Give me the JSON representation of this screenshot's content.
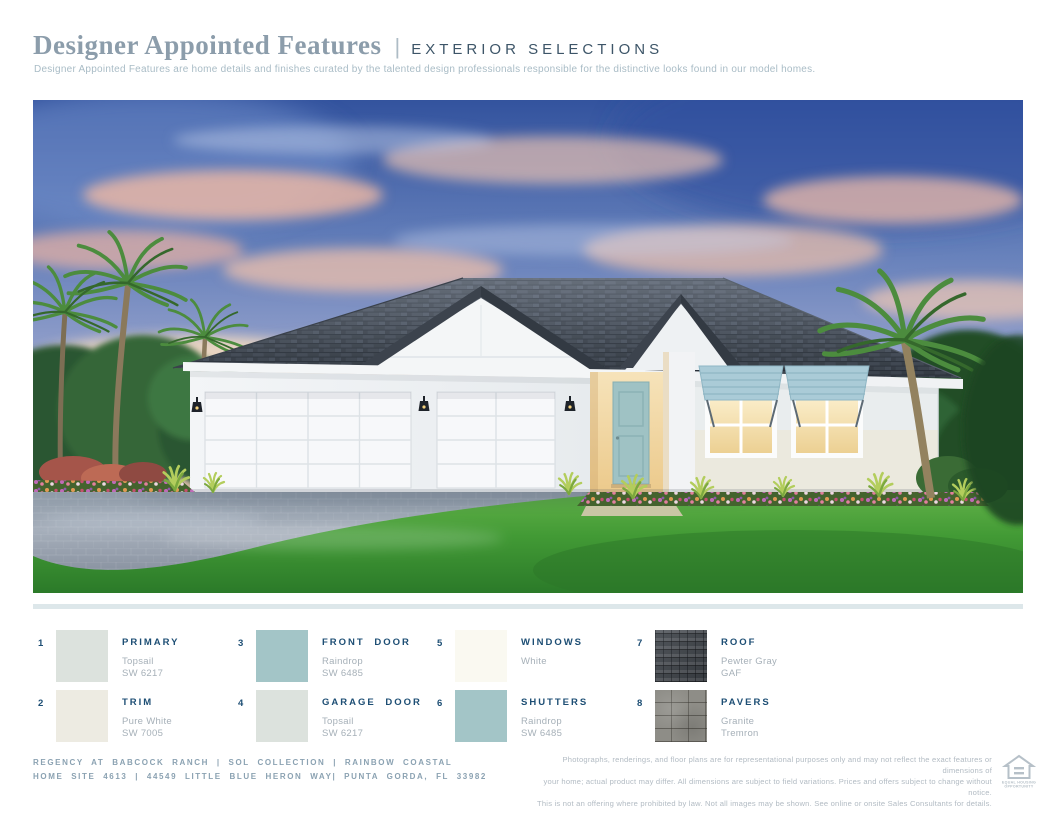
{
  "header": {
    "title": "Designer Appointed Features",
    "divider": "|",
    "section": "EXTERIOR SELECTIONS",
    "description": "Designer Appointed Features are home details and finishes curated by the talented design professionals responsible for the distinctive looks found in our model homes."
  },
  "hero": {
    "colors": {
      "sky_top": "#33539e",
      "sky_horizon": "#f9eed6",
      "cloud_pink": "#f0bfa8",
      "roof_shingle": "#434b55",
      "wall_white": "#f1f3f5",
      "front_door_teal": "#9fc2c4",
      "shutter_blue": "#aacbd7",
      "window_glow": "#f6e3b2",
      "lawn_green": "#4aa13a",
      "driveway_gray": "#98a2ae",
      "palm_green": "#4c8c3e"
    }
  },
  "swatches": [
    {
      "num": "1",
      "label": "PRIMARY",
      "name": "Topsail",
      "code": "SW 6217",
      "color": "#dce2dd"
    },
    {
      "num": "2",
      "label": "TRIM",
      "name": "Pure White",
      "code": "SW 7005",
      "color": "#edebe2"
    },
    {
      "num": "3",
      "label": "FRONT DOOR",
      "name": "Raindrop",
      "code": "SW 6485",
      "color": "#a3c5c7"
    },
    {
      "num": "4",
      "label": "GARAGE DOOR",
      "name": "Topsail",
      "code": "SW 6217",
      "color": "#dce2dd"
    },
    {
      "num": "5",
      "label": "WINDOWS",
      "name": "White",
      "code": "",
      "color": "#faf9f1"
    },
    {
      "num": "6",
      "label": "SHUTTERS",
      "name": "Raindrop",
      "code": "SW 6485",
      "color": "#a3c5c7"
    },
    {
      "num": "7",
      "label": "ROOF",
      "name": "Pewter Gray",
      "code": "GAF",
      "texture": "shingles"
    },
    {
      "num": "8",
      "label": "PAVERS",
      "name": "Granite",
      "code": "Tremron",
      "texture": "pavers"
    }
  ],
  "footer": {
    "left_line1": "REGENCY AT BABCOCK RANCH  |  SOL COLLECTION  |  RAINBOW COASTAL",
    "left_line2": "HOME SITE 4613  |  44549 LITTLE BLUE HERON WAY|  PUNTA GORDA, FL 33982",
    "disclaimer_line1": "Photographs, renderings, and floor plans are for representational purposes only and may not reflect the exact features or dimensions of",
    "disclaimer_line2": "your home; actual product may differ. All dimensions are subject to field variations. Prices and offers subject to change without notice.",
    "disclaimer_line3": "This is not an offering where prohibited by law. Not all images may be shown. See online or onsite Sales Consultants for details.",
    "equal_housing_line1": "EQUAL HOUSING",
    "equal_housing_line2": "OPPORTUNITY"
  },
  "colors": {
    "accent_navy": "#1d4e74",
    "title_slate": "#8c9dab",
    "section_slate": "#3d5568",
    "muted_gray": "#a6b0b8",
    "footer_blue_gray": "#8ba2b2",
    "disclaimer_gray": "#b2bbc3",
    "divider_bar": "#dde7ea"
  }
}
